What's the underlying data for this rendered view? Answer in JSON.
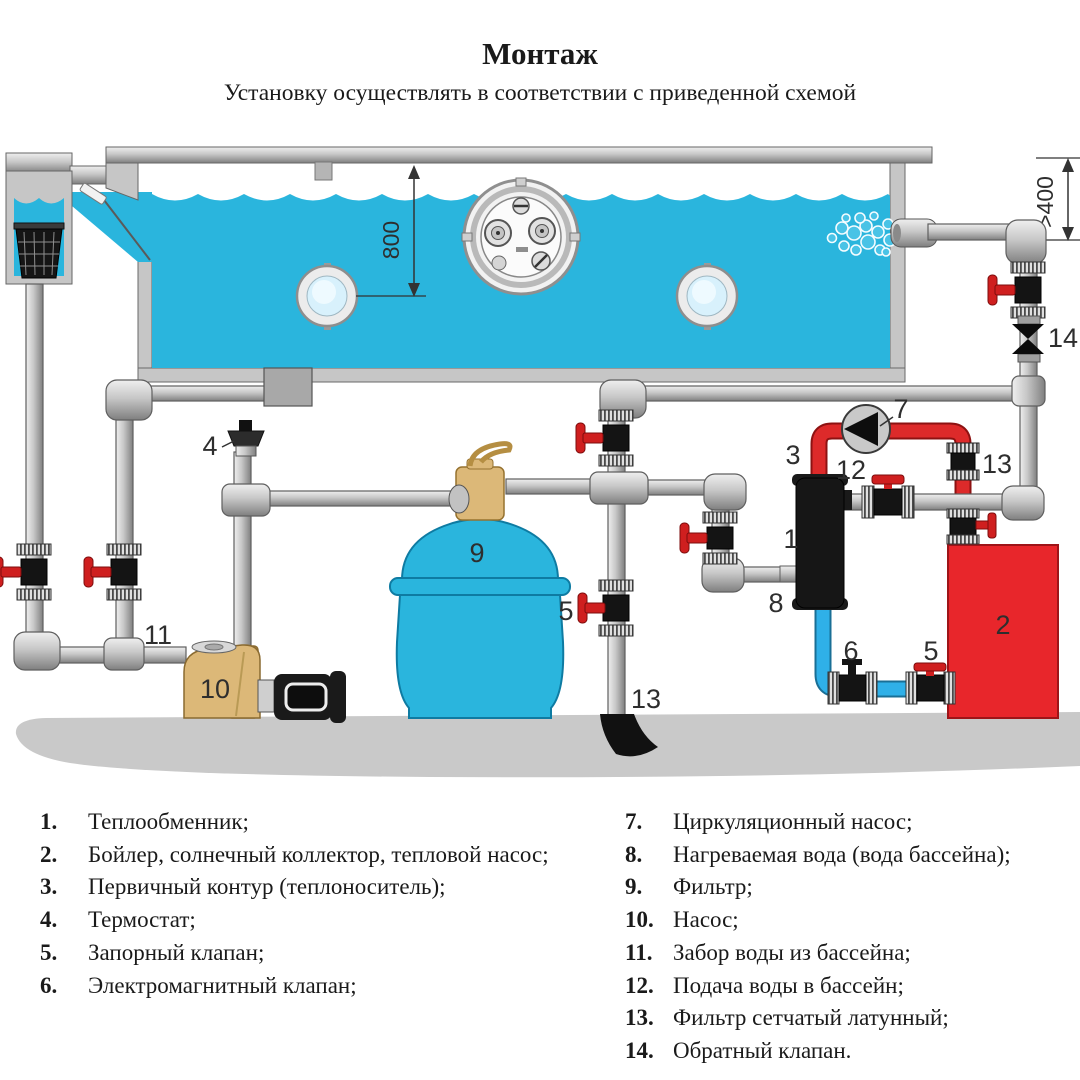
{
  "page": {
    "title": "Монтаж",
    "subtitle": "Установку осуществлять в соответствии с приведенной схемой"
  },
  "diagram": {
    "callouts": {
      "c1": "1",
      "c2": "2",
      "c3": "3",
      "c4": "4",
      "c5a": "5",
      "c5b": "5",
      "c6": "6",
      "c7": "7",
      "c8": "8",
      "c9": "9",
      "c10": "10",
      "c11": "11",
      "c12": "12",
      "c13a": "13",
      "c13b": "13",
      "c14": "14"
    },
    "dimensions": {
      "pool_depth": "800",
      "clearance": ">400"
    },
    "colors": {
      "water": "#2ab5dd",
      "boiler": "#e8262b",
      "primary_loop": "#dd2a2a",
      "return_line": "#2fb0e8",
      "pump_body": "#dcb878"
    }
  },
  "legend": {
    "left": [
      {
        "num": "1.",
        "text": "Теплообменник;"
      },
      {
        "num": "2.",
        "text": "Бойлер, солнечный коллектор, тепловой насос;"
      },
      {
        "num": "3.",
        "text": "Первичный контур (теплоноситель);"
      },
      {
        "num": "4.",
        "text": "Термостат;"
      },
      {
        "num": "5.",
        "text": "Запорный клапан;"
      },
      {
        "num": "6.",
        "text": "Электромагнитный клапан;"
      }
    ],
    "right": [
      {
        "num": "7.",
        "text": "Циркуляционный насос;"
      },
      {
        "num": "8.",
        "text": "Нагреваемая вода (вода бассейна);"
      },
      {
        "num": "9.",
        "text": "Фильтр;"
      },
      {
        "num": "10.",
        "text": "Насос;"
      },
      {
        "num": "11.",
        "text": "Забор воды из бассейна;"
      },
      {
        "num": "12.",
        "text": "Подача воды в бассейн;"
      },
      {
        "num": "13.",
        "text": "Фильтр сетчатый латунный;"
      },
      {
        "num": "14.",
        "text": "Обратный клапан."
      }
    ]
  }
}
